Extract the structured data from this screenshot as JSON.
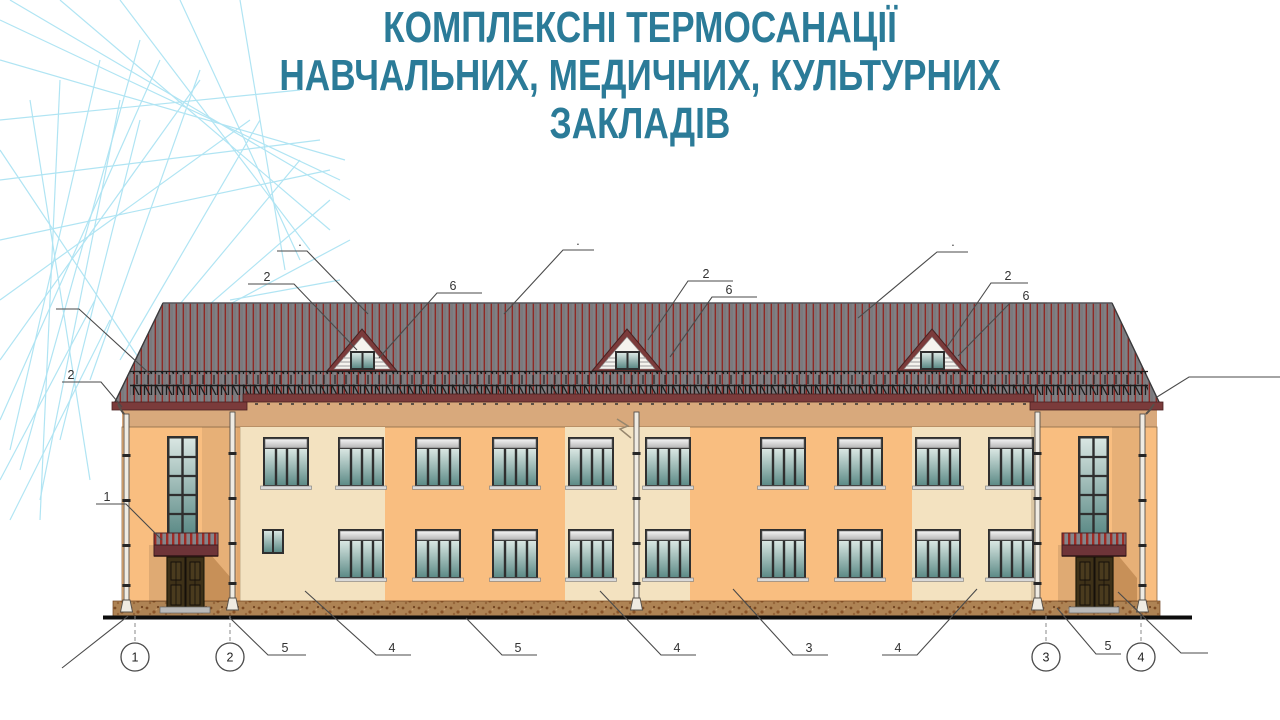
{
  "slide": {
    "title": {
      "line1": "КОМПЛЕКСНІ ТЕРМОСАНАЦІЇ",
      "line2": "НАВЧАЛЬНИХ, МЕДИЧНИХ, КУЛЬТУРНИХ",
      "line3": "ЗАКЛАДІВ"
    },
    "title_color": "#2B7B98"
  },
  "drawing": {
    "type": "building-facade-elevation",
    "axes": [
      {
        "label": "1"
      },
      {
        "label": "2"
      },
      {
        "label": "3"
      },
      {
        "label": "4"
      }
    ],
    "leader_labels": [
      {
        "label": "2"
      },
      {
        "label": "1"
      },
      {
        "label": "·"
      },
      {
        "label": "2"
      },
      {
        "label": "6"
      },
      {
        "label": "·"
      },
      {
        "label": "2"
      },
      {
        "label": "6"
      },
      {
        "label": "·"
      },
      {
        "label": "2"
      },
      {
        "label": "6"
      },
      {
        "label": "5"
      },
      {
        "label": "4"
      },
      {
        "label": "5"
      },
      {
        "label": "4"
      },
      {
        "label": "3"
      },
      {
        "label": "4"
      },
      {
        "label": "5"
      }
    ],
    "colors": {
      "roof_gray": "#808084",
      "roof_stripe": "#8E2A26",
      "eave_band": "#7B3B3B",
      "wall_orange": "#F9BE80",
      "wall_cream": "#F3E2C0",
      "frieze_tan": "#D8A97C",
      "plinth_brown": "#AE8354",
      "glass_teal": "#5D8B87",
      "door_brown": "#3E3118",
      "decoration_cyan": "#A8E2F2"
    }
  }
}
